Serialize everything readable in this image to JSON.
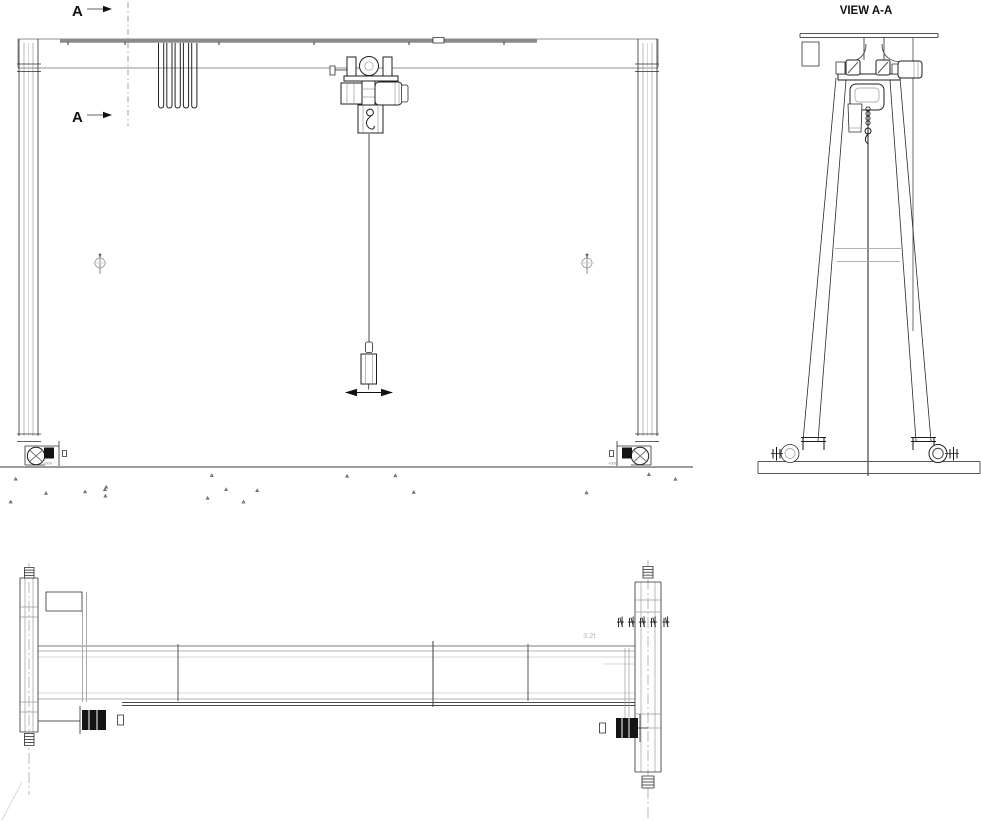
{
  "front_view": {
    "section_label": "A",
    "wheel_note_left": "+500",
    "wheel_note_right": "+500"
  },
  "side_view": {
    "title": "VIEW A-A"
  },
  "plan_view": {
    "capacity_note": "3.2t"
  },
  "icons": {
    "lightning-bolt-icon": "high-voltage warning bolt",
    "section-arrow-icon": "filled section-cut arrow",
    "travel-direction-arrows-icon": "double-headed hook travel arrow",
    "datum-target-icon": "circled datum marker"
  },
  "colors": {
    "line": "#1f1f1f",
    "beam_gray": "#8f8f8f",
    "rail_gray": "#8a8a8a",
    "faint": "#c6c6c6",
    "background": "#ffffff"
  }
}
